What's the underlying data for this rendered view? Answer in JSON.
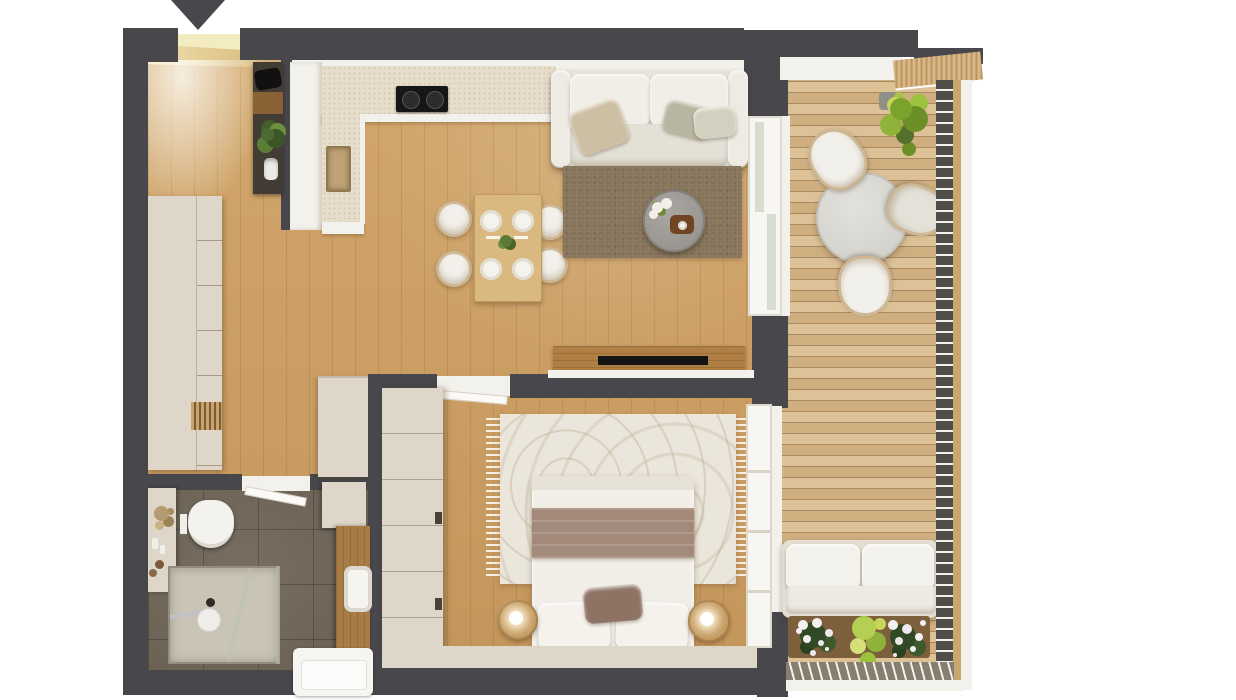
{
  "meta": {
    "kind": "apartment-floor-plan-3d-render",
    "entrance_marker": "down-arrow"
  },
  "colors": {
    "wall": "#48474c",
    "wood": "#d2a76c",
    "wood_dark": "#c3955a",
    "deck": "#ddc197",
    "deck_dark": "#cfae80",
    "deck_gap": "#a98a60",
    "tile": "#6f6557",
    "cream": "#ded6c9",
    "white_face": "#f3f1ec",
    "counter": "#e6ddcb",
    "glow": "#f3ecc0",
    "rug_living": "#87755c",
    "rug_bed": "#ebe6db",
    "blanket": "#a2897a",
    "sideboard_wood": "#b07f44",
    "table_wood": "#d9b980",
    "nightstand_wood": "#c49a5f",
    "rattan": "#cdb795",
    "railing_dark": "#504e4a",
    "railing_tan": "#c8a76f",
    "greenery": "#7ba32c",
    "greenery_light": "#b5ce54",
    "flower_white": "#f5f0f2",
    "blossom_green": "#2f4a24",
    "cooktop_black": "#161616",
    "sofa_cream": "#f0eee7",
    "shower_tray": "#cac4b6",
    "vanity_wood": "#a87c47"
  },
  "rooms": {
    "entry": {
      "name": "entry-hall",
      "items": [
        "open-entry-door",
        "console-shelf",
        "bag",
        "potted-plant",
        "vase",
        "tall-wardrobe"
      ]
    },
    "kitchen": {
      "name": "kitchen",
      "items": [
        "l-shaped-counter",
        "two-burner-cooktop",
        "inset-sink"
      ]
    },
    "living": {
      "name": "living-room",
      "items": [
        "three-seat-sofa",
        "throw-pillows",
        "area-rug",
        "round-coffee-table",
        "flowers",
        "serving-tray",
        "dining-table",
        "four-dining-chairs",
        "four-place-settings",
        "tv-sideboard",
        "tv"
      ]
    },
    "bedroom": {
      "name": "bedroom",
      "items": [
        "double-bed",
        "blanket",
        "pillows",
        "fringed-rug",
        "wardrobe",
        "round-nightstand-left",
        "round-nightstand-right",
        "lamps",
        "balcony-window"
      ]
    },
    "bathroom": {
      "name": "bathroom",
      "items": [
        "wall-hung-toilet",
        "shower-enclosure",
        "decor-shelf",
        "wood-vanity",
        "sink",
        "washing-machine"
      ]
    },
    "balcony": {
      "name": "balcony-terrace",
      "items": [
        "round-bistro-table",
        "three-rattan-chairs",
        "corner-plant",
        "outdoor-sofa",
        "flower-planters",
        "cable-railing",
        "wood-decking",
        "slatted-screen"
      ]
    }
  }
}
